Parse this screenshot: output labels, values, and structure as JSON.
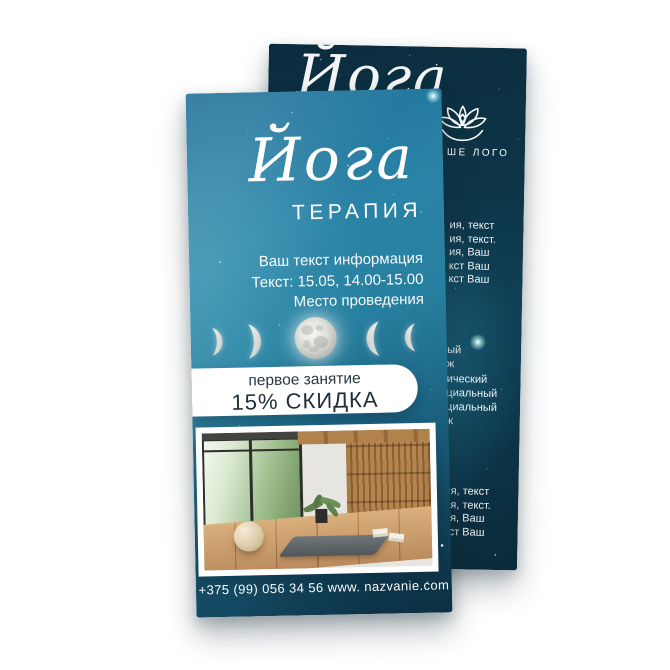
{
  "front_flyer": {
    "title_script": "Йога",
    "title": "ТЕРАПИЯ",
    "info_lines": [
      "Ваш текст информация",
      "Текст: 15.05, 14.00-15.00",
      "Место проведения"
    ],
    "offer": {
      "line1": "первое занятие",
      "line2": "15% СКИДКА"
    },
    "moon_phases": [
      "waxing-crescent-small",
      "waxing-crescent-large",
      "full-moon",
      "waning-crescent-large",
      "waning-crescent-small"
    ],
    "photo": "yoga-studio-interior",
    "contact": "+375 (99) 056 34 56 www. nazvanie.com"
  },
  "back_flyer": {
    "script_fragment": "Йога",
    "logo_icon": "lotus-logo",
    "logo_label_visible": "ШЕ ЛОГО",
    "text_block_top": [
      "ия, текст",
      "ия, текст.",
      "ия, Ваш",
      "кст Ваш",
      "кст Ваш"
    ],
    "text_block_middle": [
      "ый",
      "ж",
      "ический",
      "циальный",
      "циальный",
      "ж"
    ],
    "text_block_bottom": [
      "ия, текст",
      "ия, текст.",
      "ия, Ваш",
      "кст Ваш"
    ]
  },
  "colors": {
    "front_teal": "#2a83a6",
    "front_deep": "#113f55",
    "back_navy": "#0b2c3e",
    "back_glow": "#2c96b4",
    "pill_bg": "#ffffff",
    "pill_text": "#26323a",
    "text": "#ffffff"
  }
}
